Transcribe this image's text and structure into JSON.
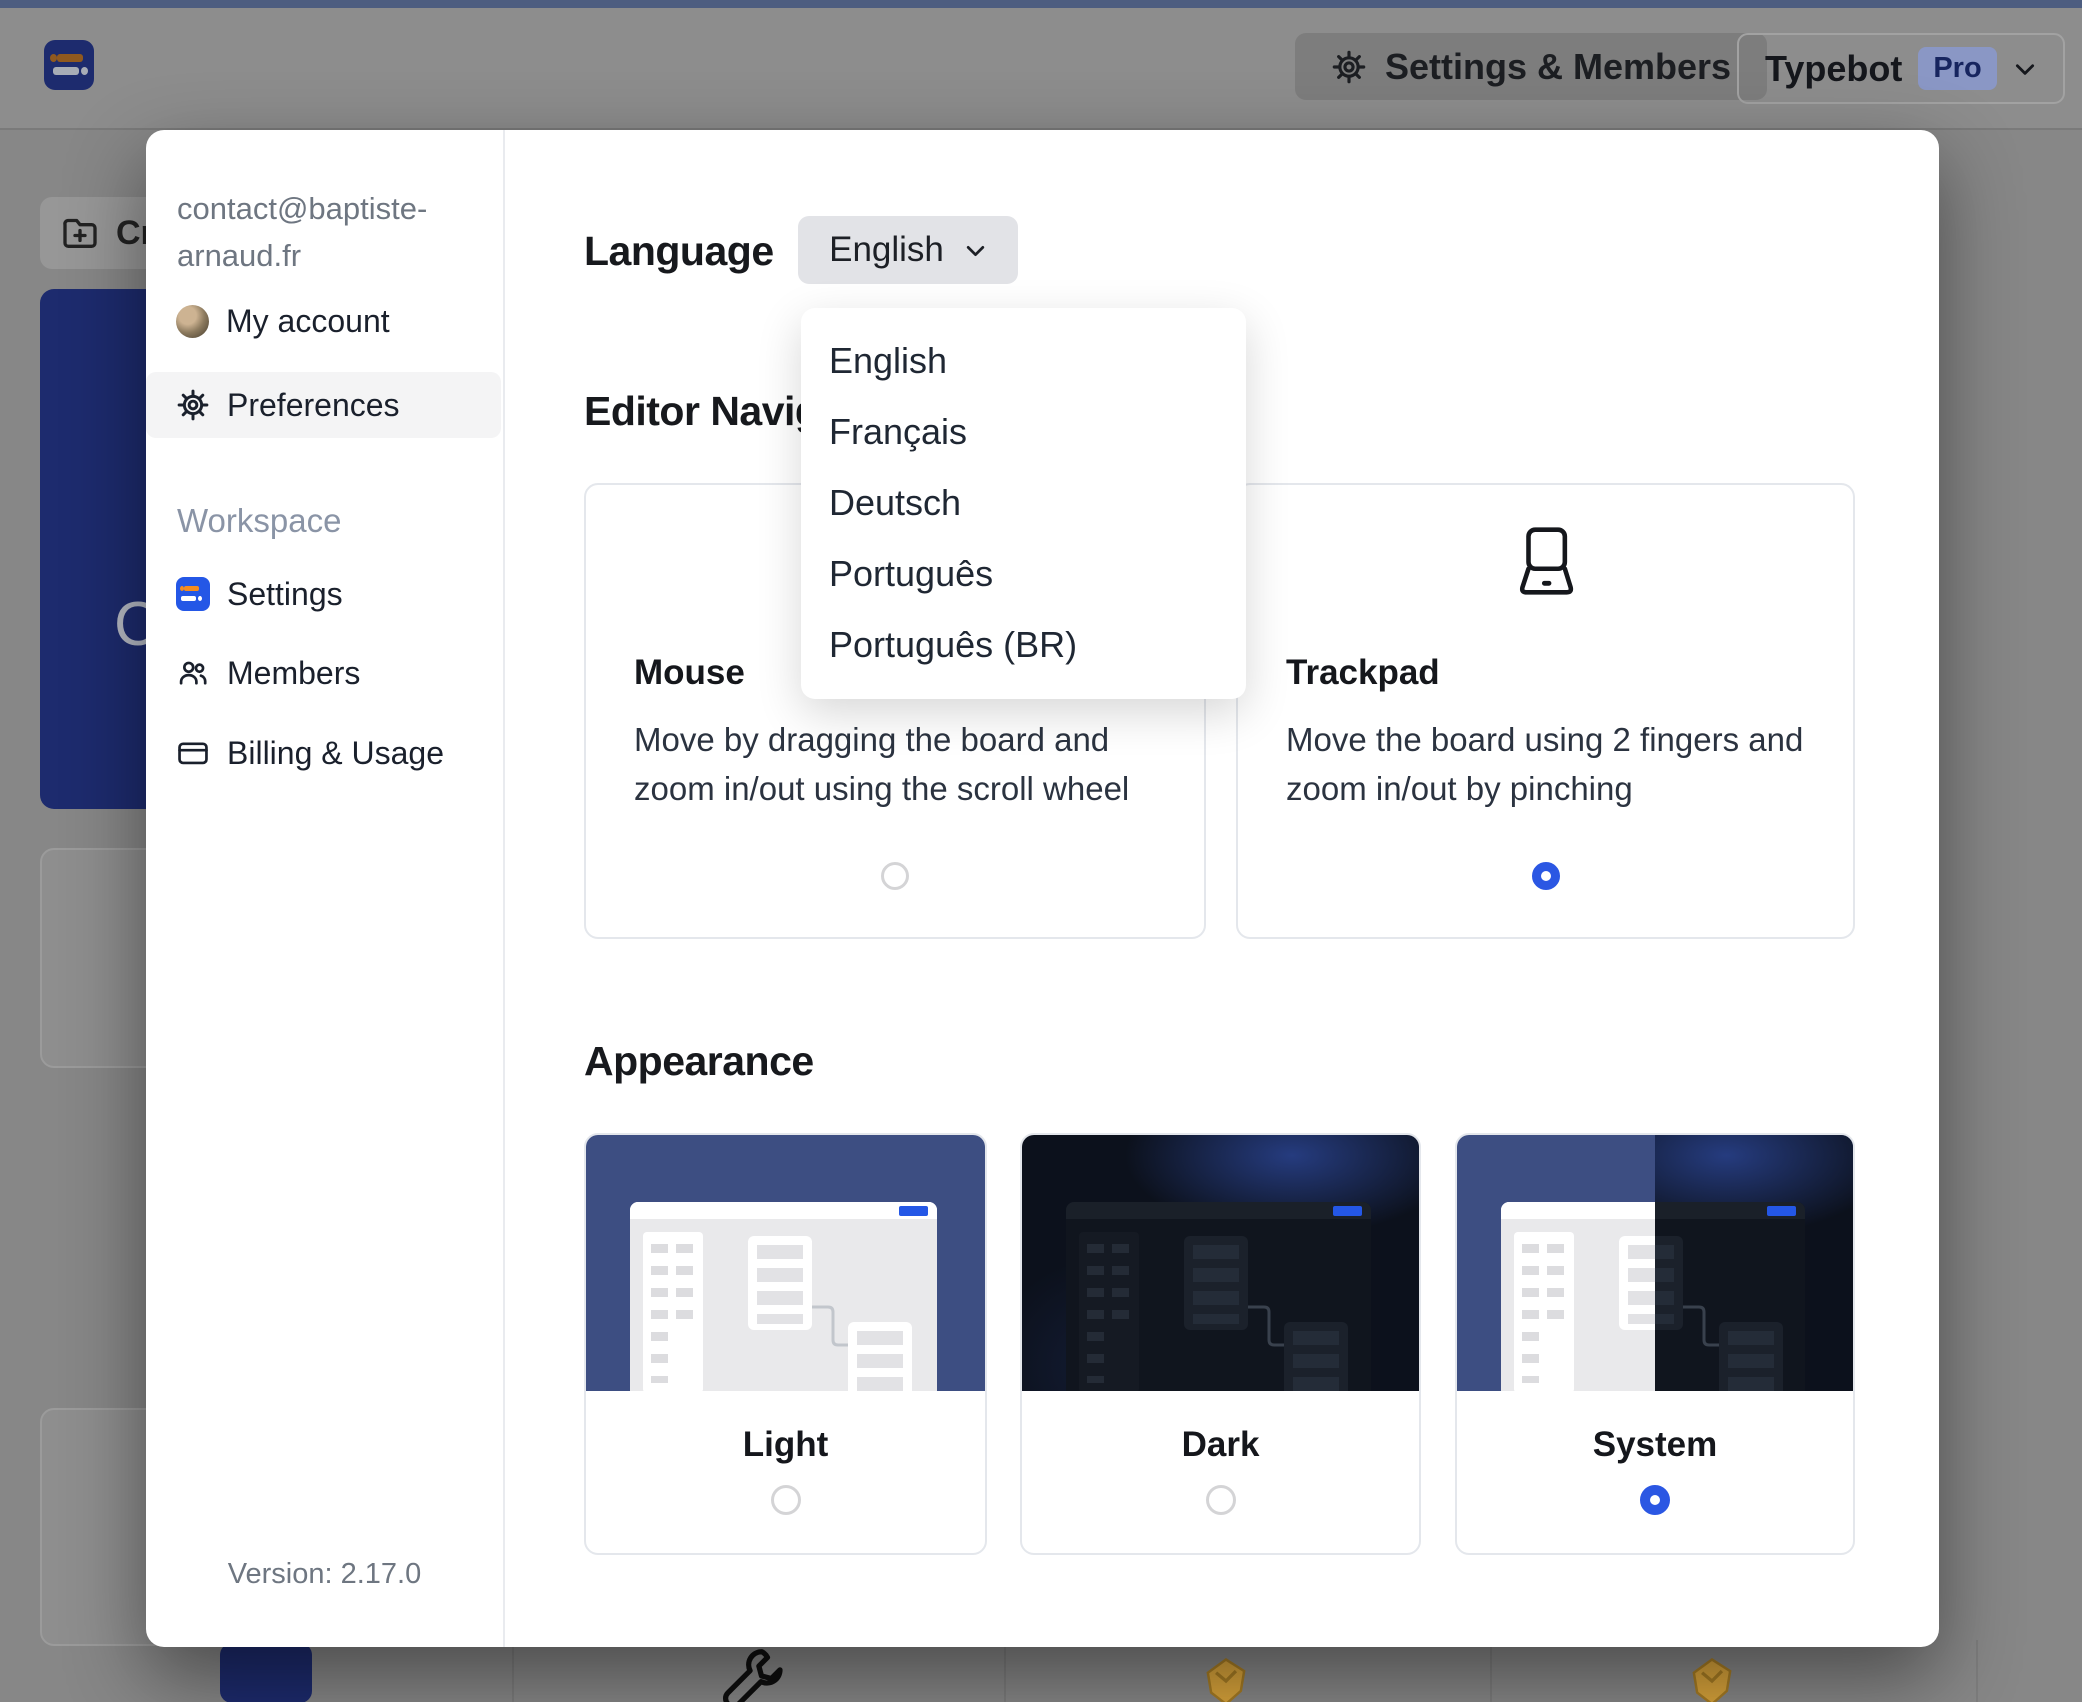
{
  "topbar": {
    "settings_members_label": "Settings & Members",
    "workspace_name": "Typebot",
    "plan_badge": "Pro"
  },
  "background": {
    "create_button_text": "Cr",
    "card_letter": "C"
  },
  "sidebar": {
    "email_line1": "contact@baptiste-",
    "email_line2": "arnaud.fr",
    "my_account": "My account",
    "preferences": "Preferences",
    "workspace_label": "Workspace",
    "settings": "Settings",
    "members": "Members",
    "billing": "Billing & Usage",
    "version": "Version: 2.17.0"
  },
  "language": {
    "label": "Language",
    "selected": "English",
    "options": [
      "English",
      "Français",
      "Deutsch",
      "Português",
      "Português (BR)"
    ]
  },
  "editor_navigation": {
    "heading": "Editor Navigation",
    "mouse": {
      "title": "Mouse",
      "description": "Move by dragging the board and zoom in/out using the scroll wheel",
      "selected": false
    },
    "trackpad": {
      "title": "Trackpad",
      "description": "Move the board using 2 fingers and zoom in/out by pinching",
      "selected": true
    }
  },
  "appearance": {
    "heading": "Appearance",
    "options": [
      {
        "label": "Light",
        "selected": false
      },
      {
        "label": "Dark",
        "selected": false
      },
      {
        "label": "System",
        "selected": true
      }
    ]
  },
  "colors": {
    "accent": "#2b57e3",
    "brand_blue": "#2457e6",
    "navy": "#1d2b6e",
    "thumb_navy": "#3d4e82",
    "pro_badge_bg": "#8a97c5",
    "pro_badge_text": "#17255f",
    "backdrop": "#878787"
  }
}
